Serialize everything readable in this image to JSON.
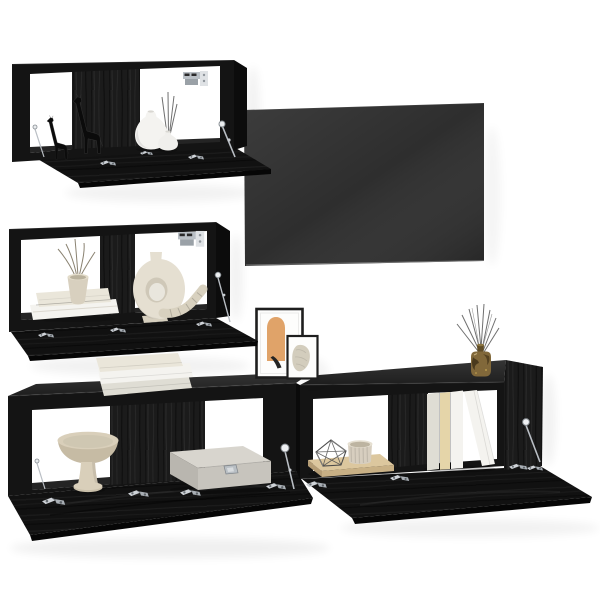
{
  "meta": {
    "kind": "product-photo",
    "subject": "4-piece black wood-look TV wall unit set with wall-mounted TV, open flap doors and decor items",
    "background": "#ffffff"
  },
  "palette": {
    "wall": "#ffffff",
    "cabinet_front": "#141414",
    "cabinet_top": "#1e1e1e",
    "cabinet_side": "#0c0c0c",
    "panel": "#1b1b1b",
    "flap": "#111111",
    "flap_edge": "#060606",
    "floor_strip": "#242424",
    "tv_screen": "#2e2e2e",
    "metal": "#b9bec4",
    "giraffe": "#0b0b0b",
    "vase_white": "#f4f3f0",
    "vase_small": "#f0efec",
    "vase_beige": "#d8d0bf",
    "donut": "#e5dfd1",
    "donut_foot": "#d6cfbe",
    "rope": "#d8d1bf",
    "book_white": "#f4f3ef",
    "book_cream": "#eae6da",
    "book_gray": "#dfddd4",
    "book_tan": "#e5d5a9",
    "bowl": "#d9cfba",
    "bowl_dark": "#c6bba4",
    "box_top": "#d8d5ce",
    "box_front": "#c7c4bd",
    "box_side": "#b9b6af",
    "board_top": "#dcc79e",
    "board_front": "#c8b085",
    "board_side": "#b59d75",
    "cup": "#d7cebf",
    "frame_border": "#1e1e1e",
    "mat": "#fdfdfc",
    "art_orange": "#e0a369",
    "art_beige": "#d3cdbd",
    "amber": "#81683a",
    "reed": "#6f6f6f",
    "twig": "#8a8271",
    "wire": "#4b4b4b"
  },
  "objects": {
    "tv": "flat-screen TV mounted on wall",
    "wall_cabinet_top": "black wall cabinet, flap door open, giraffe figurines and white vases inside",
    "wall_cabinet_middle": "black wall cabinet, flap door open, books, beige vase with twigs, ring vase and rope decor",
    "tv_stand_left": "black floor TV cabinet, flap door open, pedestal bowl and grey storage box inside, book stack on top",
    "tv_stand_right": "black floor TV cabinet, flap door open, wooden board with wire ornament and ribbed cup, standing books, reed diffuser on top",
    "picture_frames": "two leaning art prints (orange arch, beige sketch)",
    "hardware": "silver hinges, lid stays and wall brackets"
  }
}
